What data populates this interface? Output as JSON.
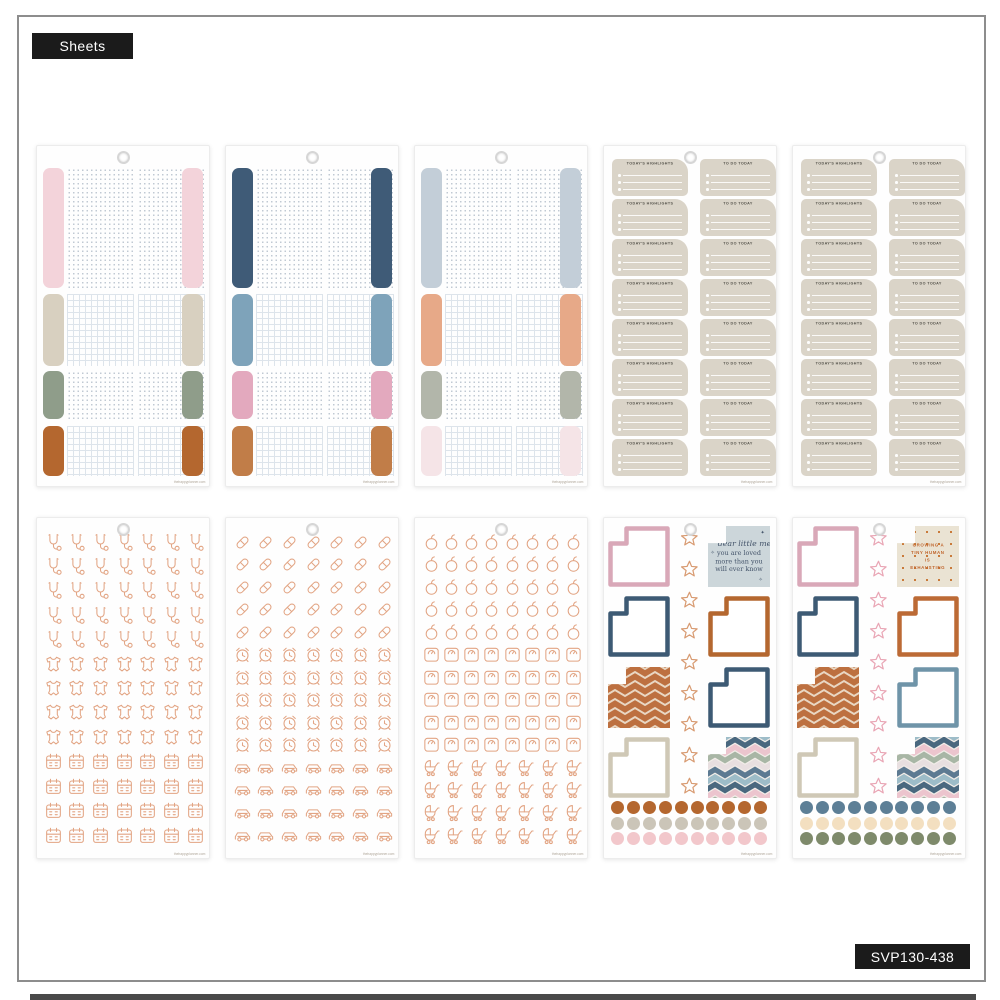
{
  "page": {
    "type_badge": "Sheets",
    "sku_badge": "SVP130-438",
    "brand_url": "thehappyplanner.com",
    "colors": {
      "badge_bg": "#1b1b1b",
      "badge_text": "#ffffff",
      "frame_border": "#8d8d8d",
      "sheet_bg": "#fefefe",
      "icon_outline": "#e2a483"
    }
  },
  "chevrons": {
    "rust": {
      "bg": "#bd7040",
      "stripe": "#e9d7c3"
    },
    "multi": {
      "bg": "#f2ede8",
      "stripes": [
        "#9dbcc8",
        "#4a687f",
        "#ecc5ce",
        "#a8b6a5",
        "#e8dfe0",
        "#5d7a92"
      ]
    }
  },
  "sheets": [
    {
      "id": "index-tabs-1",
      "type": "tabs",
      "tab_colors": [
        "#f3d3da",
        "#d8d0c0",
        "#8f9d8a",
        "#b4672f"
      ],
      "patterns": [
        "dots",
        "grid",
        "dots",
        "grid"
      ]
    },
    {
      "id": "index-tabs-2",
      "type": "tabs",
      "tab_colors": [
        "#3f5b77",
        "#7ea3ba",
        "#e3a9be",
        "#c17d48"
      ],
      "patterns": [
        "dots",
        "grid",
        "dots",
        "grid"
      ]
    },
    {
      "id": "index-tabs-3",
      "type": "tabs",
      "tab_colors": [
        "#c3ced8",
        "#e7a988",
        "#b2b6aa",
        "#f5e4e7"
      ],
      "patterns": [
        "dots",
        "grid",
        "dots",
        "grid"
      ]
    },
    {
      "id": "daily-labels-1",
      "type": "labels",
      "left_title": "TODAY'S HIGHLIGHTS",
      "right_title": "TO DO TODAY",
      "rows": 8,
      "lines_per_sticker": 3,
      "sticker_color": "#dad4c8",
      "title_color": "#55534b"
    },
    {
      "id": "daily-labels-2",
      "type": "labels",
      "left_title": "TODAY'S HIGHLIGHTS",
      "right_title": "TO DO TODAY",
      "rows": 8,
      "lines_per_sticker": 3,
      "sticker_color": "#dad4c8",
      "title_color": "#55534b"
    },
    {
      "id": "icons-baby-health",
      "type": "icons",
      "icon_color": "#e2a483",
      "groups": [
        {
          "icon": "stethoscope",
          "rows": 5,
          "cols": 7
        },
        {
          "icon": "baby-onesie",
          "rows": 4,
          "cols": 7
        },
        {
          "icon": "calendar",
          "rows": 4,
          "cols": 7
        }
      ]
    },
    {
      "id": "icons-meds-time",
      "type": "icons",
      "icon_color": "#e2a483",
      "groups": [
        {
          "icon": "pill",
          "rows": 5,
          "cols": 7
        },
        {
          "icon": "alarm-clock",
          "rows": 5,
          "cols": 7
        },
        {
          "icon": "car",
          "rows": 4,
          "cols": 7
        }
      ]
    },
    {
      "id": "icons-food-baby",
      "type": "icons",
      "icon_color": "#e2a483",
      "groups": [
        {
          "icon": "apple",
          "rows": 5,
          "cols": 8
        },
        {
          "icon": "scale",
          "rows": 5,
          "cols": 8
        },
        {
          "icon": "stroller",
          "rows": 4,
          "cols": 7
        }
      ]
    },
    {
      "id": "squares-stars-1",
      "type": "squares",
      "star_color": "#d89b72",
      "star_count": 9,
      "left_column": [
        {
          "kind": "outline",
          "color": "#d9a8b8"
        },
        {
          "kind": "outline",
          "color": "#3d5a74"
        },
        {
          "kind": "chevron-rust"
        },
        {
          "kind": "outline",
          "color": "#cfc8b6"
        }
      ],
      "right_column": [
        {
          "kind": "quote"
        },
        {
          "kind": "outline",
          "color": "#b4672f"
        },
        {
          "kind": "outline",
          "color": "#3d5a74"
        },
        {
          "kind": "chevron-multi"
        }
      ],
      "quote": {
        "style": "script-serif",
        "bg": "#ccd6da",
        "text_color": "#44546a",
        "script_line": "dear little me",
        "lines": [
          "you are loved",
          "more than you",
          "will ever know"
        ]
      },
      "dot_rows": [
        "#b4672f",
        "#cbc5b8",
        "#f2c7cb"
      ]
    },
    {
      "id": "squares-stars-2",
      "type": "squares",
      "star_color": "#e9a6b5",
      "star_count": 9,
      "left_column": [
        {
          "kind": "outline",
          "color": "#d9a8b8"
        },
        {
          "kind": "outline",
          "color": "#3d5a74"
        },
        {
          "kind": "chevron-rust"
        },
        {
          "kind": "outline",
          "color": "#cfc8b6"
        }
      ],
      "right_column": [
        {
          "kind": "quote"
        },
        {
          "kind": "outline",
          "color": "#bc6a35"
        },
        {
          "kind": "outline",
          "color": "#6f94a8"
        },
        {
          "kind": "chevron-multi"
        }
      ],
      "quote": {
        "style": "caps",
        "bg": "#eae3d3",
        "text_color": "#c0662e",
        "lines": [
          "GROWING A",
          "TINY HUMAN",
          "IS",
          "EXHAUSTING"
        ]
      },
      "dot_rows": [
        "#5d7f96",
        "#f3dfc0",
        "#7e8a6b"
      ]
    }
  ]
}
